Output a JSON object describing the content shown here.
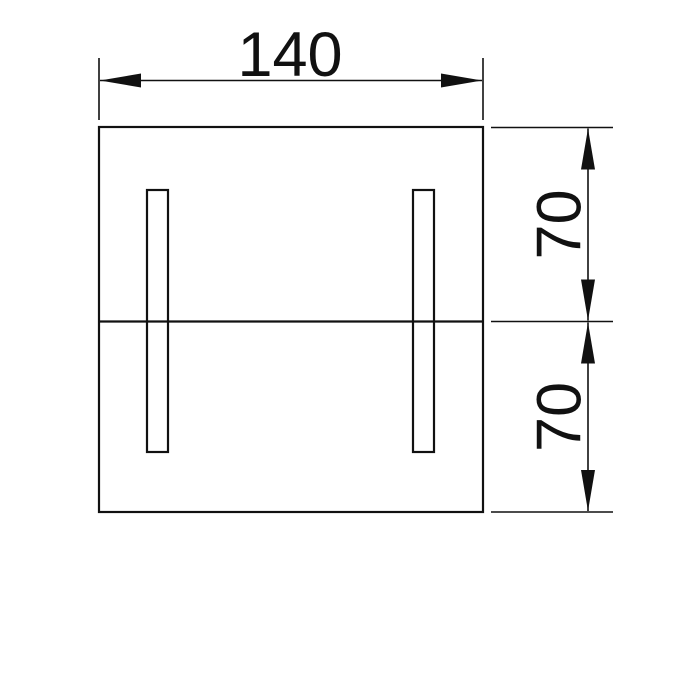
{
  "drawing": {
    "kind": "technical-drawing",
    "background_color": "#ffffff",
    "line_color": "#111111",
    "dimensions": {
      "width": {
        "value": "140",
        "orientation": "horizontal"
      },
      "upper_height": {
        "value": "70",
        "orientation": "vertical"
      },
      "lower_height": {
        "value": "70",
        "orientation": "vertical"
      }
    }
  }
}
